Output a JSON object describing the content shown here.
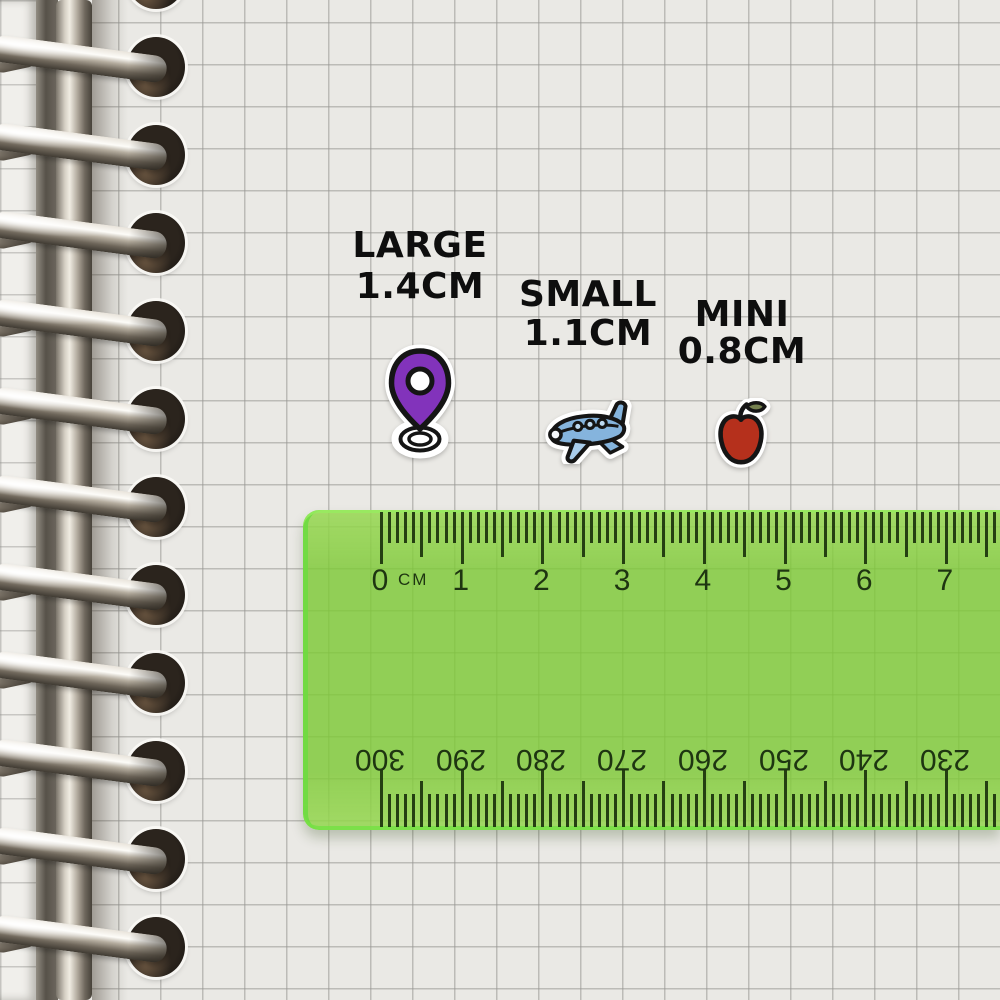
{
  "labels": [
    {
      "name": "LARGE",
      "size": "1.4CM"
    },
    {
      "name": "SMALL",
      "size": "1.1CM"
    },
    {
      "name": "MINI",
      "size": "0.8CM"
    }
  ],
  "stickers": [
    {
      "icon": "location-pin-sticker"
    },
    {
      "icon": "airplane-sticker"
    },
    {
      "icon": "apple-sticker"
    }
  ],
  "ruler": {
    "unit_label": "CM",
    "cm_numbers": [
      "0",
      "1",
      "2",
      "3",
      "4",
      "5",
      "6",
      "7"
    ],
    "mm_numbers": [
      "300",
      "290",
      "280",
      "270",
      "260",
      "250",
      "240",
      "230"
    ]
  },
  "colors": {
    "pin_purple": "#8233bb",
    "plane_blue": "#85b4dd",
    "plane_blue_light": "#a9cdec",
    "window_blue": "#bcd9f0",
    "apple_red": "#b5301c",
    "leaf_olive": "#75814f",
    "outline_black": "#151515",
    "ruler_green": "#7ec936",
    "marking_green": "#1e3511",
    "label_text": "#0e0e0e"
  }
}
